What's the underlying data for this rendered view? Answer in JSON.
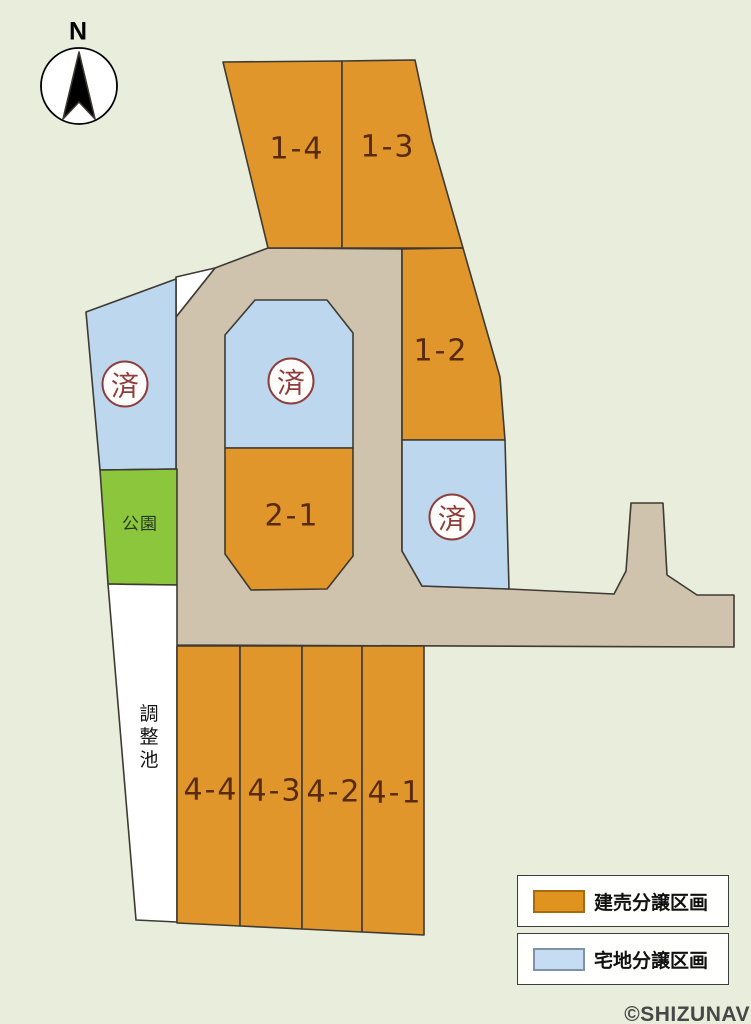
{
  "compass": {
    "label": "N"
  },
  "lots": {
    "lot_1_4": "1-4",
    "lot_1_3": "1-3",
    "lot_1_2": "1-2",
    "lot_2_1": "2-1",
    "lot_4_4": "4-4",
    "lot_4_3": "4-3",
    "lot_4_2": "4-2",
    "lot_4_1": "4-1"
  },
  "areas": {
    "park": "公園",
    "retention_pond": "調整池"
  },
  "sold_stamp": "済",
  "legend": {
    "items": [
      {
        "label": "建売分譲区画",
        "color": "#e0941f"
      },
      {
        "label": "宅地分譲区画",
        "color": "#c5dcf2"
      }
    ]
  },
  "watermark": "©SHIZUNAV",
  "colors": {
    "background": "#e9eedc",
    "built_for_sale_lot": "#e0962a",
    "residential_lot": "#bdd8ee",
    "road": "#cfc3ae",
    "park": "#8cc63c",
    "pond": "#ffffff",
    "stamp_red": "#8e3d3d",
    "lot_text": "#582a0e"
  }
}
